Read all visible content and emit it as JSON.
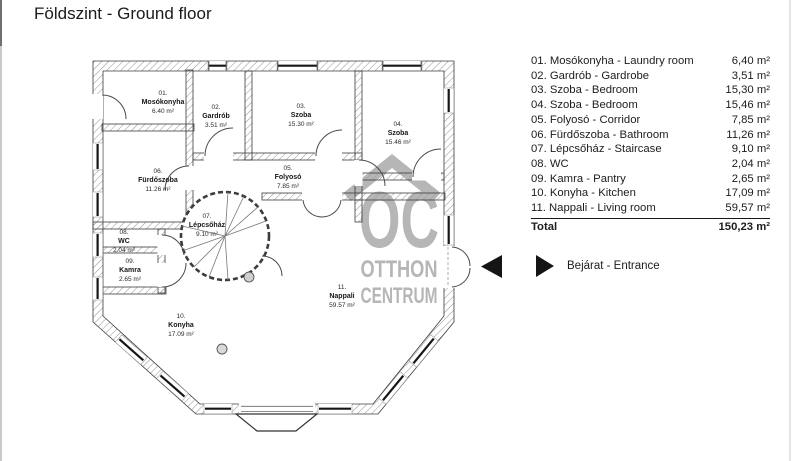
{
  "title": "Földszint - Ground floor",
  "legend": {
    "rows": [
      {
        "label": "01. Mosókonyha - Laundry room",
        "area": "6,40 m²"
      },
      {
        "label": "02. Gardrób - Gardrobe",
        "area": "3,51 m²"
      },
      {
        "label": "03. Szoba - Bedroom",
        "area": "15,30 m²"
      },
      {
        "label": "04. Szoba - Bedroom",
        "area": "15,46 m²"
      },
      {
        "label": "05. Folyosó - Corridor",
        "area": "7,85 m²"
      },
      {
        "label": "06. Fürdőszoba - Bathroom",
        "area": "11,26 m²"
      },
      {
        "label": "07. Lépcsőház - Staircase",
        "area": "9,10 m²"
      },
      {
        "label": "08. WC",
        "area": "2,04 m²"
      },
      {
        "label": "09. Kamra - Pantry",
        "area": "2,65 m²"
      },
      {
        "label": "10. Konyha - Kitchen",
        "area": "17,09 m²"
      },
      {
        "label": "11. Nappali - Living room",
        "area": "59,57 m²"
      }
    ],
    "total_label": "Total",
    "total_area": "150,23 m²"
  },
  "entrance": {
    "label": "Bejárat - Entrance"
  },
  "plan": {
    "rooms": [
      {
        "num": "01.",
        "name": "Mosókonyha",
        "area": "6.40 m²"
      },
      {
        "num": "02.",
        "name": "Gardrób",
        "area": "3.51 m²"
      },
      {
        "num": "03.",
        "name": "Szoba",
        "area": "15.30 m²"
      },
      {
        "num": "04.",
        "name": "Szoba",
        "area": "15.46 m²"
      },
      {
        "num": "05.",
        "name": "Folyosó",
        "area": "7.85 m²"
      },
      {
        "num": "06.",
        "name": "Fürdőszoba",
        "area": "11.26 m²"
      },
      {
        "num": "07.",
        "name": "Lépcsőház",
        "area": "9.10 m²"
      },
      {
        "num": "08.",
        "name": "WC",
        "area": "2.04 m²"
      },
      {
        "num": "09.",
        "name": "Kamra",
        "area": "2.65 m²"
      },
      {
        "num": "10.",
        "name": "Konyha",
        "area": "17.09 m²"
      },
      {
        "num": "11.",
        "name": "Nappali",
        "area": "59.57 m²"
      }
    ],
    "watermark": {
      "initials": "OC",
      "line1": "OTTHON",
      "line2": "CENTRUM"
    }
  },
  "colors": {
    "watermark": "#b6b6b6",
    "entrance_arrow": "#151515",
    "text": "#1c1c1c",
    "wall_hatch": "#9a9a9a"
  }
}
